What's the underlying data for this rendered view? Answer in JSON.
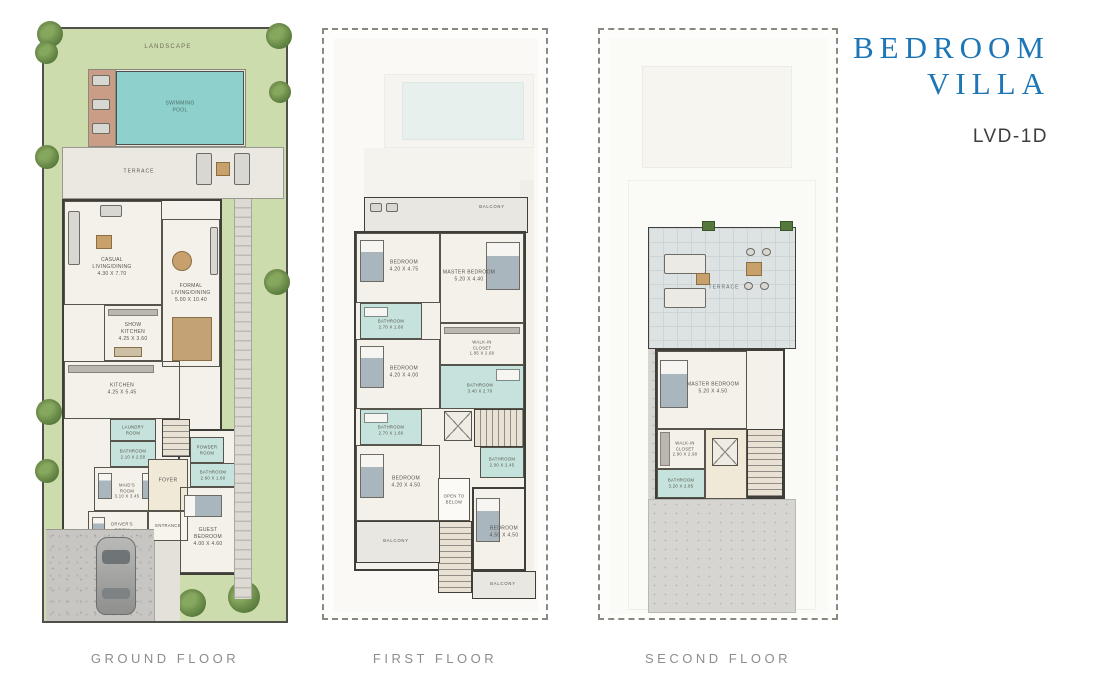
{
  "header": {
    "title_line1": "7 BEDROOM",
    "title_line2": "VILLA",
    "unit_code": "LVD-1D"
  },
  "palette": {
    "accent_blue": "#1d76b5",
    "pool_teal": "#8ed0cb",
    "landscape_green": "#cddcad",
    "bathroom_teal": "#c6e2dc",
    "wall_dark": "#3f3f39",
    "caption_gray": "#8e8d8a"
  },
  "plans": [
    {
      "caption": "GROUND FLOOR",
      "labels": {
        "landscape": "LANDSCAPE",
        "swimming_pool": "SWIMMING\nPOOL",
        "terrace": "TERRACE",
        "casual_living": "CASUAL\nLIVING/DINING\n4.30 X 7.70",
        "formal_living": "FORMAL\nLIVING/DINING\n5.00 X 10.40",
        "show_kitchen": "SHOW\nKITCHEN\n4.25 X 3.60",
        "kitchen": "KITCHEN\n4.25 X 5.45",
        "laundry": "LAUNDRY\nROOM",
        "bathroom1": "BATHROOM\n2.10 X 2.50",
        "maids_room": "MAID'S\nROOM\n3.10 X 3.45",
        "foyer": "FOYER",
        "entrance": "ENTRANCE",
        "drivers_room": "DRIVER'S\nROOM\n3.10 X 2.45",
        "powder_room": "POWDER\nROOM",
        "bathroom2": "BATHROOM\n2.60 X 1.60",
        "guest_bedroom": "GUEST\nBEDROOM\n4.00 X 4.60"
      }
    },
    {
      "caption": "FIRST FLOOR",
      "labels": {
        "balcony_top": "BALCONY",
        "bedroom1": "BEDROOM\n4.20 X 4.75",
        "master_bedroom": "MASTER BEDROOM\n5.20 X 4.40",
        "bathroom1": "BATHROOM\n2.70 X 1.60",
        "walk_in_closet": "WALK-IN\nCLOSET\n1.95 X 2.60",
        "master_bathroom": "BATHROOM\n3.40 X 2.70",
        "bedroom2": "BEDROOM\n4.20 X 4.00",
        "bathroom2": "BATHROOM\n2.70 X 1.60",
        "bedroom3": "BEDROOM\n4.20 X 4.50",
        "bathroom3": "BATHROOM\n2.00 X 2.45",
        "open_to_below": "OPEN TO\nBELOW",
        "bedroom4": "BEDROOM\n4.50 X 4.50",
        "balcony_left": "BALCONY",
        "balcony_right": "BALCONY"
      }
    },
    {
      "caption": "SECOND FLOOR",
      "labels": {
        "terrace": "TERRACE",
        "master_bedroom": "MASTER BEDROOM\n5.20 X 4.50",
        "walk_in_closet": "WALK-IN\nCLOSET\n2.90 X 2.90",
        "bathroom": "BATHROOM\n3.20 X 2.85"
      }
    }
  ]
}
